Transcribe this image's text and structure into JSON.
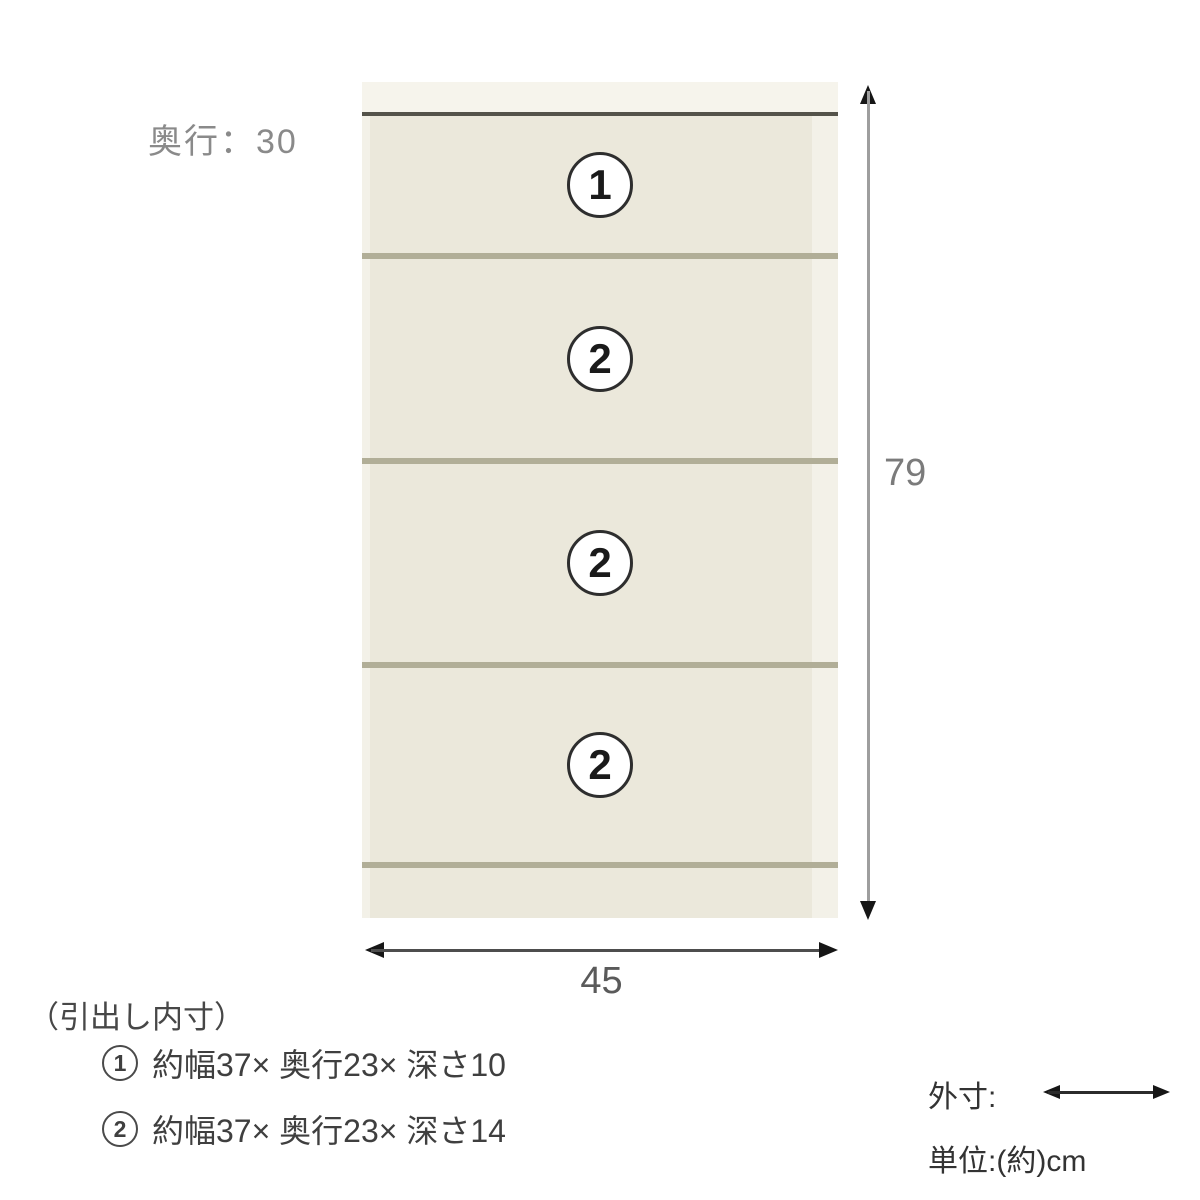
{
  "cabinet": {
    "depth_label": "奥行：30",
    "drawers": [
      {
        "num": "1"
      },
      {
        "num": "2"
      },
      {
        "num": "2"
      },
      {
        "num": "2"
      }
    ],
    "colors": {
      "body": "#f3f1e8",
      "face": "#ebe8db",
      "divider": "#b1ae97",
      "topline": "#54534a"
    }
  },
  "dimensions": {
    "height": "79",
    "width": "45"
  },
  "inner_note": {
    "title": "（引出し内寸）",
    "items": [
      {
        "num": "1",
        "text": "約幅37× 奥行23× 深さ10"
      },
      {
        "num": "2",
        "text": "約幅37× 奥行23× 深さ14"
      }
    ]
  },
  "legend": {
    "outer_label": "外寸:",
    "unit_label": "単位:(約)cm"
  }
}
